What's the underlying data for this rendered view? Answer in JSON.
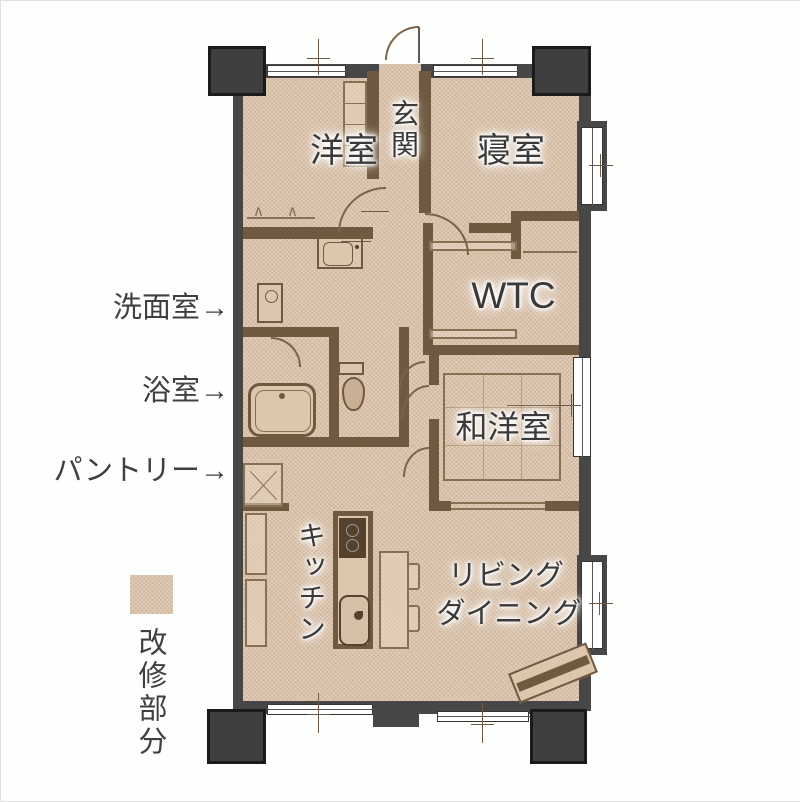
{
  "colors": {
    "floor_renovated": "#d9c1a9",
    "interior_wall": "#6f5a41",
    "outer_wall": "#474747",
    "pillar": "#3f3f3f",
    "label_text": "#3a3a3a"
  },
  "rooms": {
    "entrance": {
      "label": "玄関"
    },
    "western_room": {
      "label": "洋室"
    },
    "bedroom": {
      "label": "寝室"
    },
    "wtc": {
      "label": "WTC"
    },
    "japanese_western_room": {
      "label": "和洋室"
    },
    "kitchen": {
      "label": "キッチン"
    },
    "living_dining": {
      "line1": "リビング",
      "line2": "ダイニング"
    }
  },
  "callouts": [
    {
      "label": "洗面室",
      "arrow": "→"
    },
    {
      "label": "浴室",
      "arrow": "→"
    },
    {
      "label": "パントリー",
      "arrow": "→"
    }
  ],
  "legend": {
    "label": "改修部分",
    "swatch_color": "#d9c1a9"
  },
  "icons": {
    "hanger": "∧"
  }
}
